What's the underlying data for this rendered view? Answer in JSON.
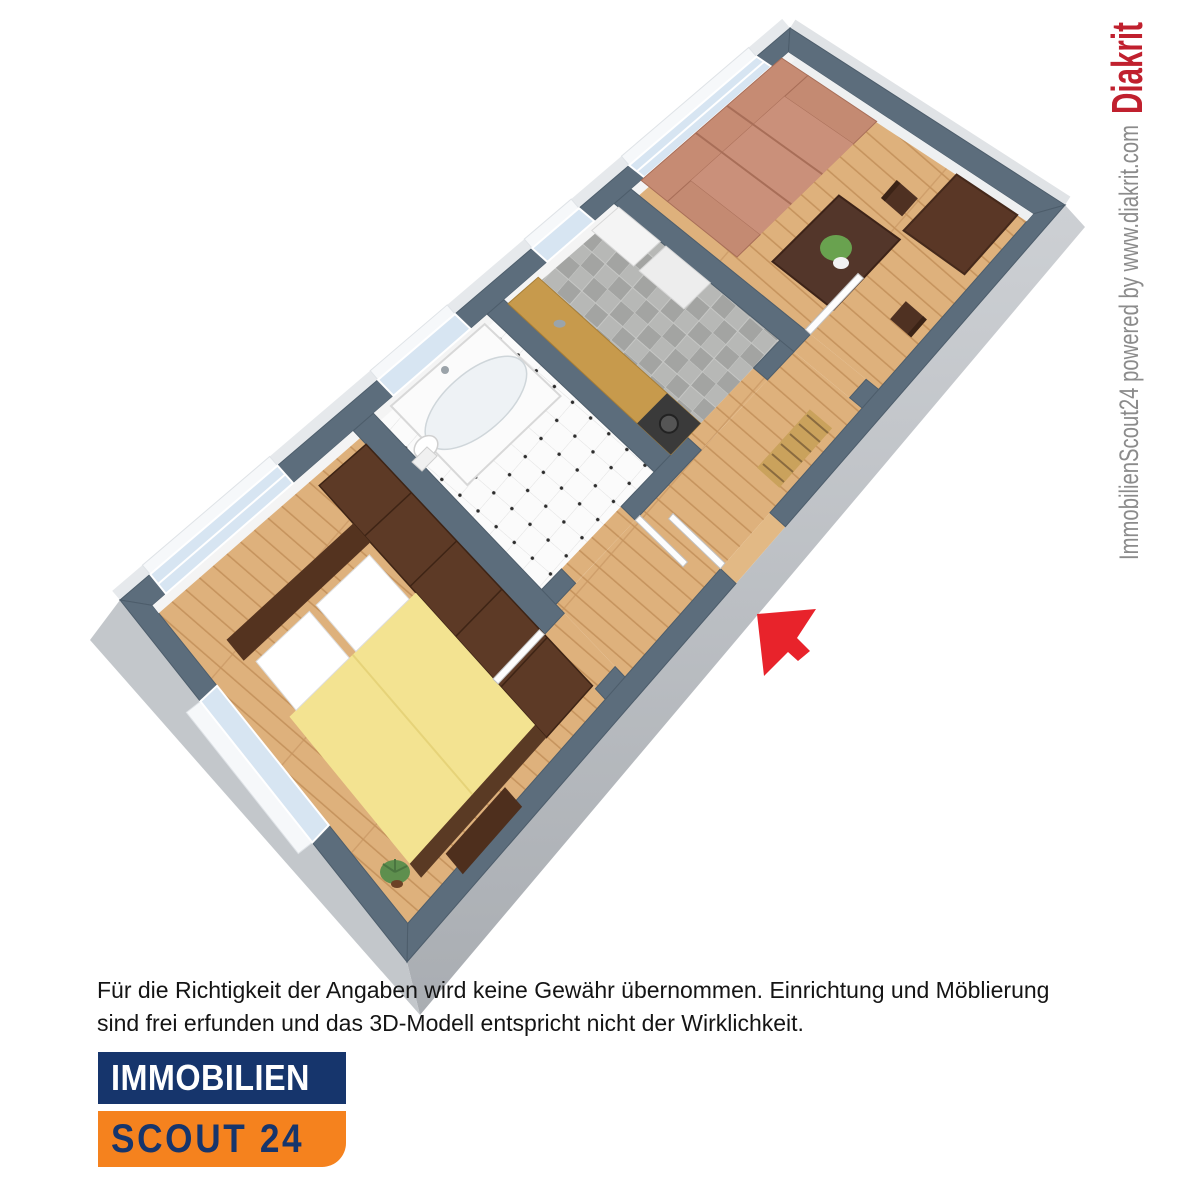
{
  "watermark": {
    "powered_by": "ImmobilienScout24 powered by www.diakrit.com",
    "brand": "Diakrit",
    "brand_color": "#c0202e",
    "text_color": "#8b8b8b"
  },
  "disclaimer": {
    "line1": "Für die Richtigkeit der Angaben wird keine Gewähr übernommen. Einrichtung und Möblierung",
    "line2": "sind frei erfunden und das 3D-Modell entspricht nicht der Wirklichkeit."
  },
  "logo": {
    "top": "IMMOBILIEN",
    "bottom": "SCOUT 24",
    "navy": "#16356c",
    "orange": "#f5821e"
  },
  "floorplan": {
    "type": "3d-isometric-floorplan",
    "rooms": [
      {
        "name": "living-room",
        "floor": "wood",
        "furniture": [
          "sofa",
          "coffee-table",
          "plant",
          "dining-table",
          "dining-chairs"
        ]
      },
      {
        "name": "kitchen",
        "floor": "gray-checker-tile",
        "furniture": [
          "counter",
          "stove",
          "fridge",
          "cabinet"
        ]
      },
      {
        "name": "bathroom",
        "floor": "white-checker-tile",
        "furniture": [
          "bathtub",
          "toilet"
        ]
      },
      {
        "name": "hallway",
        "floor": "wood",
        "furniture": [
          "radiator"
        ]
      },
      {
        "name": "bedroom",
        "floor": "wood",
        "furniture": [
          "double-bed",
          "wardrobe",
          "bench",
          "plant"
        ]
      }
    ],
    "windows": 5,
    "doors": [
      "entrance",
      "bedroom-door",
      "bathroom-door",
      "living-room-door"
    ],
    "entrance_marker": "red-arrow",
    "colors": {
      "wall_top": "#5c6d7c",
      "outer_wall": "#c3c7cb",
      "wood_floor": "#deb17c",
      "kitchen_tile": "#aeafad",
      "bath_tile": "#fbfbfb",
      "sofa": "#c48a72",
      "bed_blanket": "#f3e391",
      "dark_furniture": "#54331f",
      "arrow_red": "#e8232b",
      "window_glass": "#d7e5f2"
    }
  }
}
